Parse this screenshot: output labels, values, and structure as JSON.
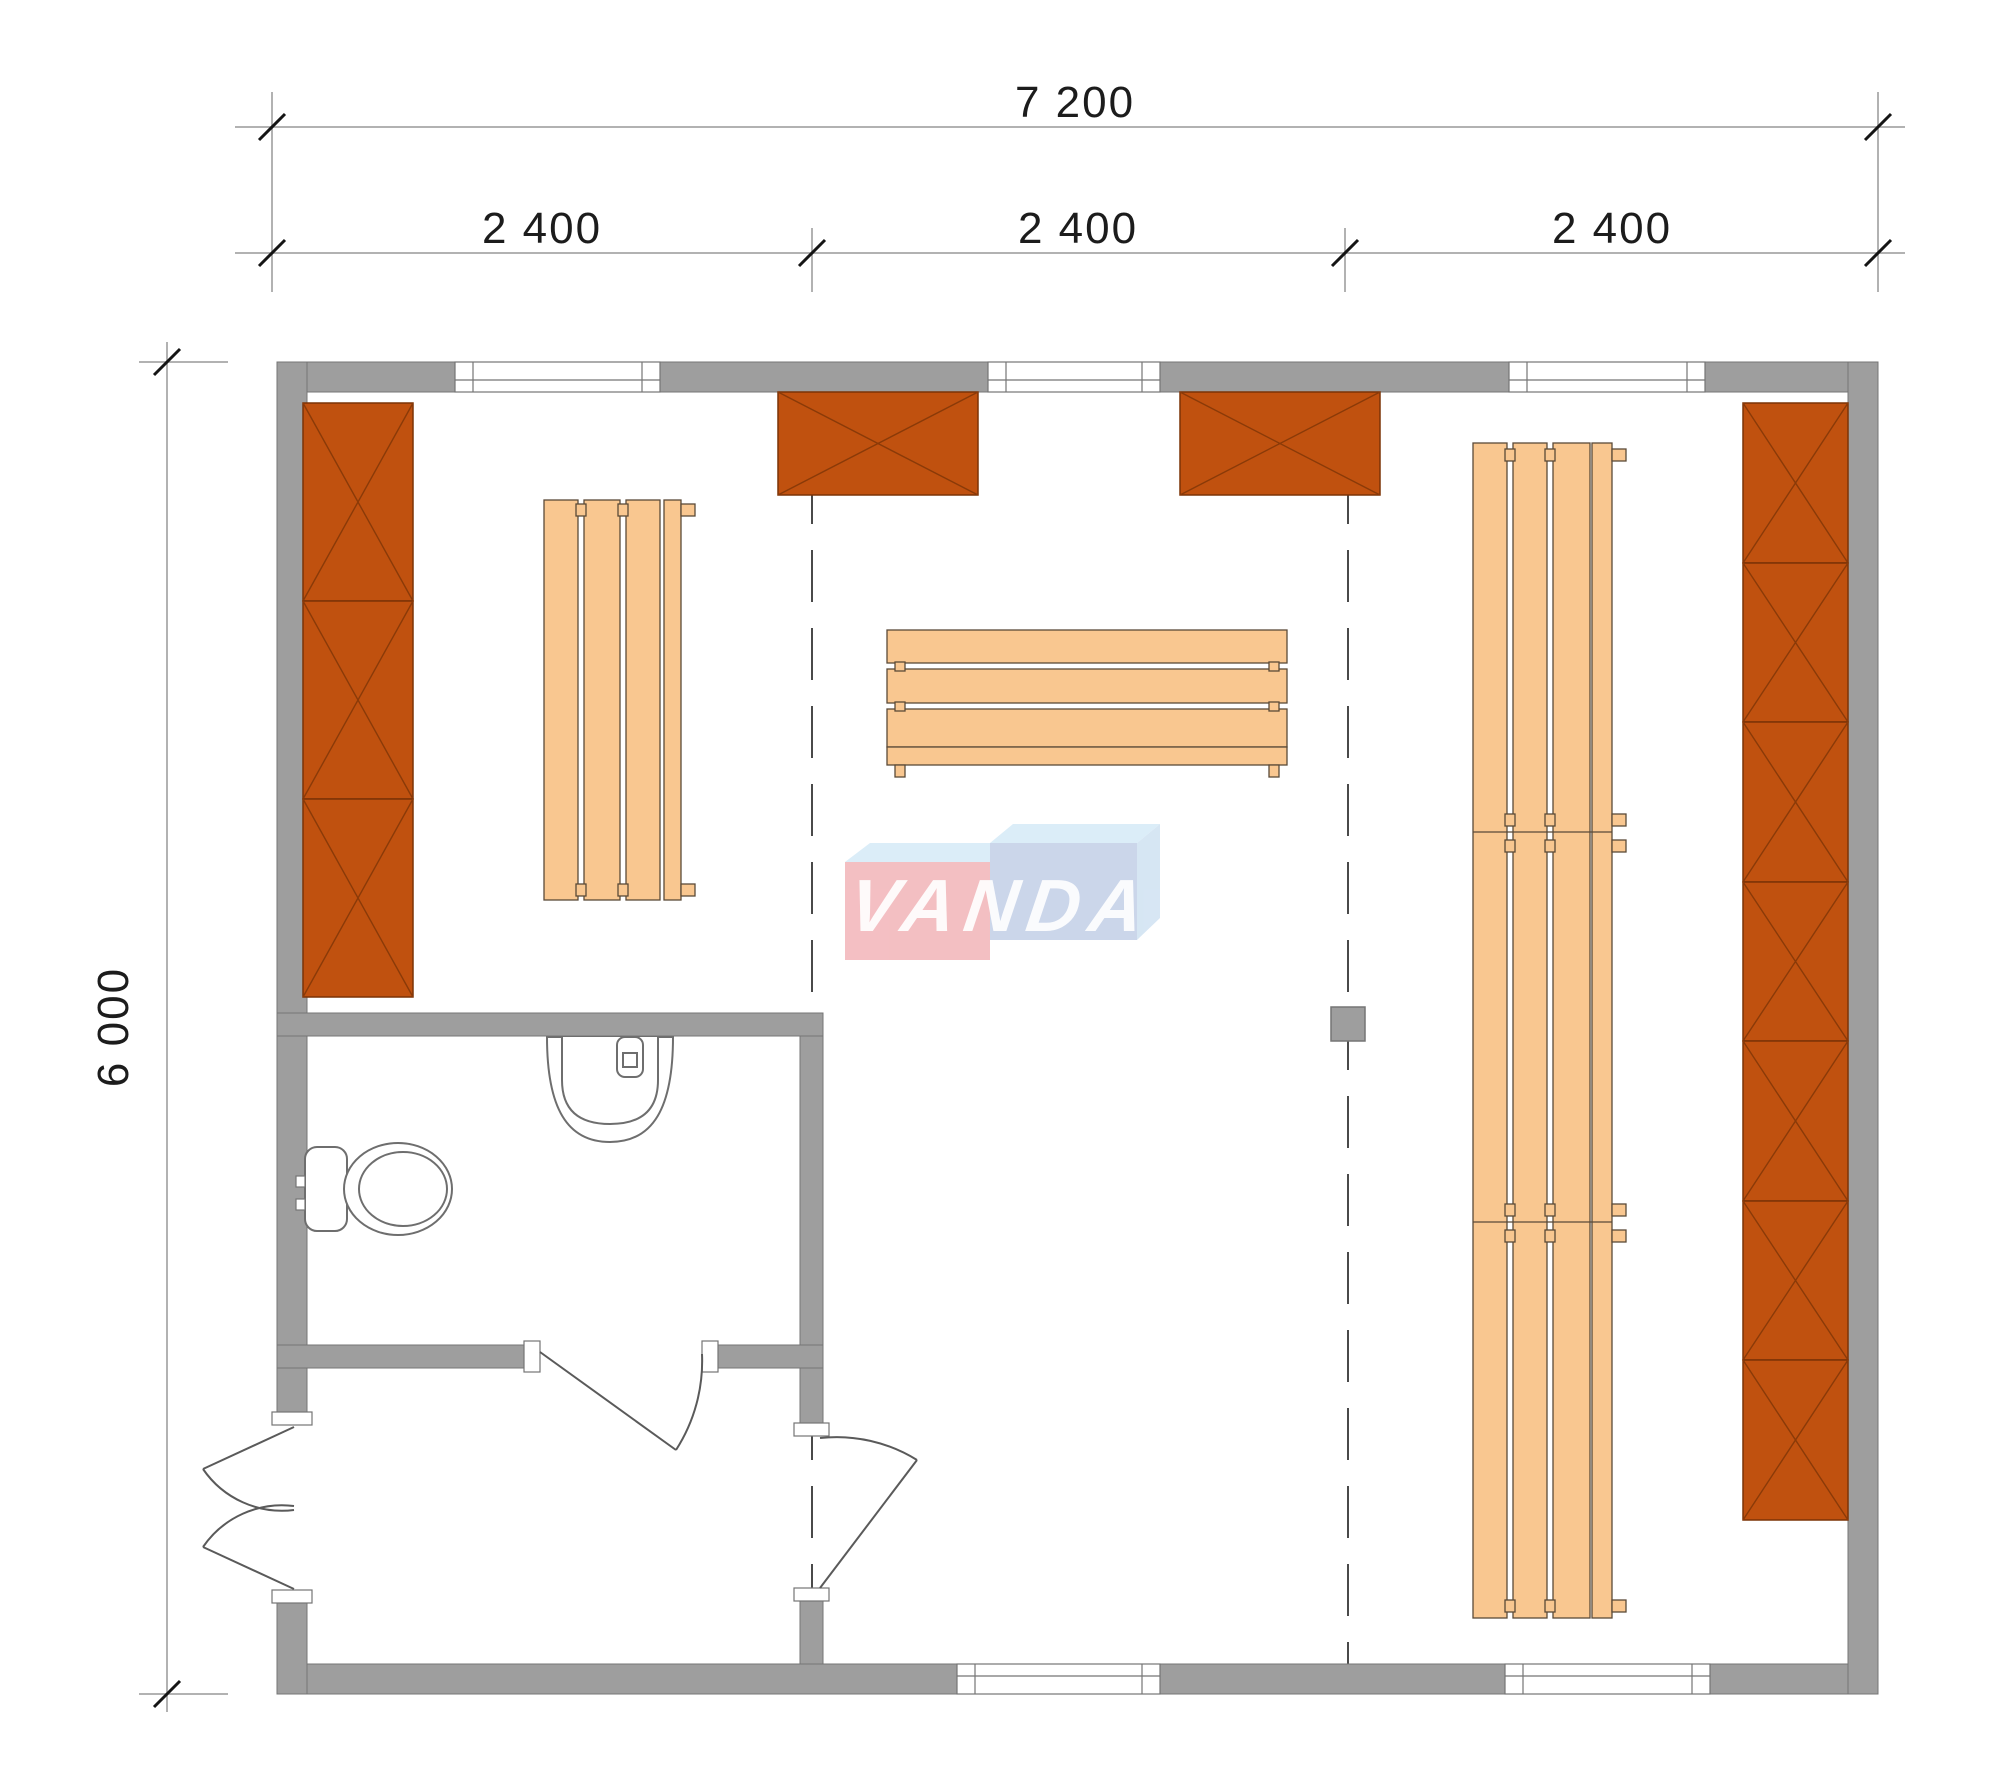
{
  "watermark": {
    "text": "VANDA"
  },
  "dimensions": {
    "overall_width_label": "7 200",
    "module_labels": [
      "2 400",
      "2 400",
      "2 400"
    ],
    "overall_height_label": "6 000"
  },
  "colors": {
    "wall": "#9e9e9e",
    "wall_edge": "#757575",
    "cabinet": "#c0510f",
    "cabinet_edge": "#7c3306",
    "bench": "#f9c790",
    "bench_edge": "#5a4a38",
    "line": "#4a4a4a",
    "dim_line": "#999999",
    "dim_text": "#1c1c1c",
    "fixture": "#6e6e6e",
    "logo_pink": "#f2b4b8",
    "logo_blue": "#c3cfe7",
    "logo_top": "#d5eaf7",
    "logo_side": "#d0e2f2",
    "logo_text": "#ffffff"
  },
  "plan": {
    "elements": [
      "outer-walls",
      "top-windows",
      "bottom-windows",
      "module-dashed-lines",
      "wall-cabinet-left",
      "wall-cabinet-right",
      "heater-left",
      "heater-right",
      "bench-left",
      "bench-middle",
      "bench-right",
      "support-post",
      "bathroom",
      "toilet",
      "sink",
      "bathroom-door",
      "main-room-door",
      "entrance-double-door"
    ],
    "cabinet_left_sections": 3,
    "cabinet_right_sections": 7,
    "bench_right_sections": 3
  }
}
